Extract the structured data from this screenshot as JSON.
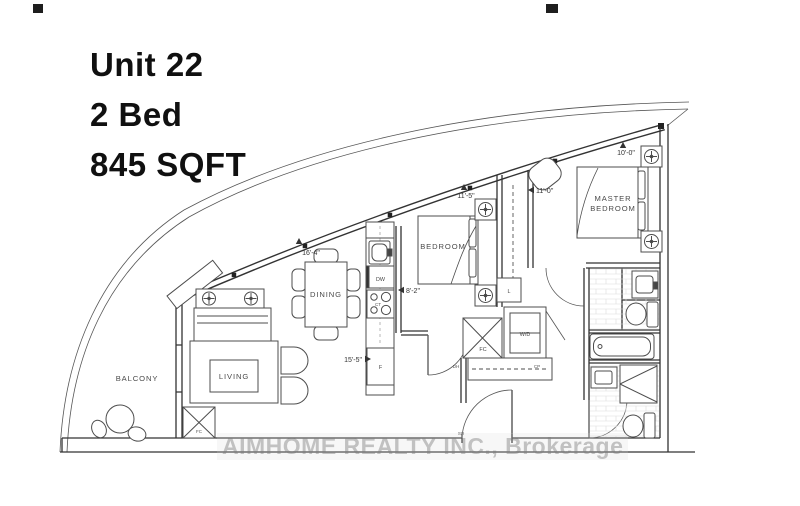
{
  "title": {
    "unit": "Unit 22",
    "beds": "2 Bed",
    "area": "845 SQFT"
  },
  "rooms": {
    "balcony": "BALCONY",
    "living": "LIVING",
    "dining": "DINING",
    "bedroom": "BEDROOM",
    "master_line1": "MASTER",
    "master_line2": "BEDROOM"
  },
  "dimensions": {
    "living_width": "16'-4\"",
    "living_length": "15'-5\"",
    "bedroom_width": "8'-2\"",
    "bedroom_length": "11'-5\"",
    "master_width": "11'-0\"",
    "master_length": "10'-0\""
  },
  "fixtures": {
    "washer_dryer": "W/D",
    "fridge": "F",
    "dishwasher": "DW",
    "cooktop": "CT",
    "foyer_closet": "FC",
    "living_closet": "FC",
    "linen": "L",
    "carpet": "CP",
    "door_hw": "DH",
    "shoe": "SH"
  },
  "watermark": "AIMHOME REALTY INC., Brokerage",
  "colors": {
    "line": "#333333",
    "label": "#4a4a4a",
    "watermark": "#8f8f8f",
    "background": "#ffffff"
  }
}
